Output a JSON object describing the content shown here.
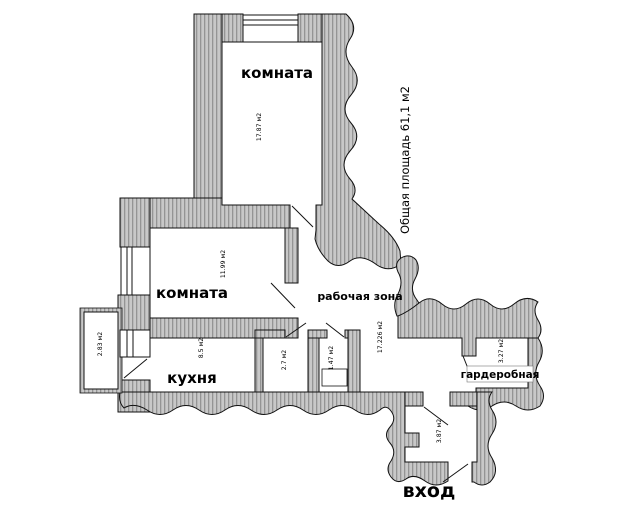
{
  "plan": {
    "total_area": "Общая площадь 61,1 м2",
    "rooms": {
      "room_top": {
        "name": "комната",
        "area": "17.87 м2"
      },
      "room_mid": {
        "name": "комната",
        "area": "11.99 м2"
      },
      "kitchen": {
        "name": "кухня",
        "area": "8.5 м2"
      },
      "work_zone": {
        "name": "рабочая зона",
        "area": "17.226 м2"
      },
      "wardrobe": {
        "name": "гардеробная",
        "area": "3.27 м2"
      },
      "balcony": {
        "area": "2.83 м2"
      },
      "bathroom": {
        "area": "2.7 м2"
      },
      "wc": {
        "area": "1.47 м2"
      },
      "entry_hall": {
        "area": "3.87 м2"
      },
      "entrance": {
        "name": "вход"
      }
    },
    "colors": {
      "wall_fill": "#c8c8c8",
      "wall_stripe": "#949494",
      "outline": "#111111"
    }
  }
}
